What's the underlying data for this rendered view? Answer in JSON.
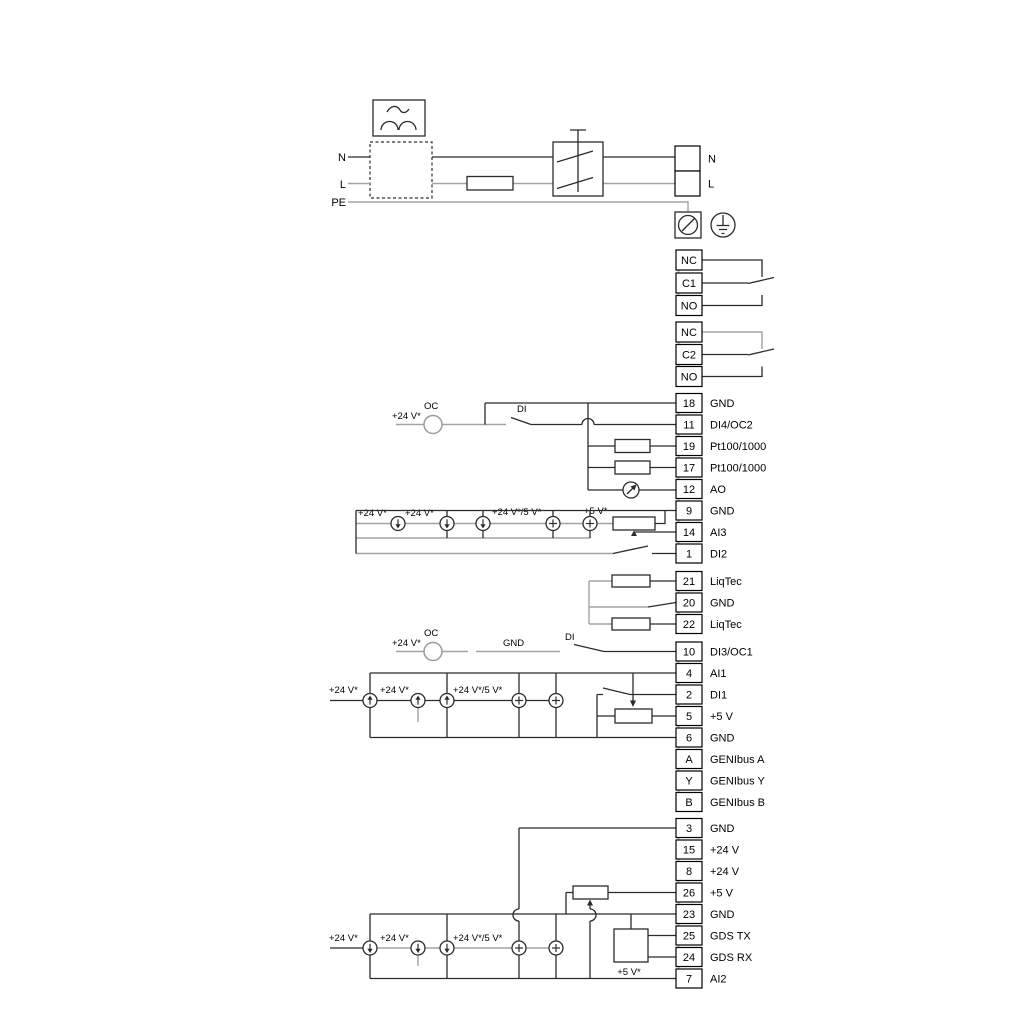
{
  "colors": {
    "wire_dark": "#2b2b2b",
    "wire_gray": "#a3a3a3",
    "background": "#ffffff"
  },
  "mains": {
    "n_in": "N",
    "l_in": "L",
    "pe": "PE"
  },
  "labels": {
    "g2_supply": "+24 V*",
    "g2_oc": "OC",
    "g2_di": "DI",
    "rowA_s1": "+24 V*",
    "rowA_s2": "+24 V*",
    "rowA_s3": "+24 V*/5 V*",
    "rowA_s4": "+5 V*",
    "g4_supply": "+24 V*",
    "g4_oc": "OC",
    "g4_gnd": "GND",
    "g4_di": "DI",
    "rowB_s1": "+24 V*",
    "rowB_s2": "+24 V*",
    "rowB_s3": "+24 V*/5 V*",
    "rowC_s1": "+24 V*",
    "rowC_s2": "+24 V*",
    "rowC_s3": "+24 V*/5 V*",
    "rowC_s4": "+5 V*"
  },
  "terminal_groups": [
    {
      "id": "mains-out",
      "x": 675,
      "w": 25,
      "h": 25,
      "label_x": 708,
      "ys": [
        158.5,
        183.5
      ],
      "cells": [
        {
          "num": "",
          "label": "N"
        },
        {
          "num": "",
          "label": "L"
        }
      ]
    },
    {
      "id": "relay1",
      "x": 676,
      "w": 26,
      "h": 20,
      "label_x": 710,
      "ys": [
        260,
        283,
        305.5
      ],
      "cells": [
        {
          "num": "NC",
          "label": ""
        },
        {
          "num": "C1",
          "label": ""
        },
        {
          "num": "NO",
          "label": ""
        }
      ]
    },
    {
      "id": "relay2",
      "x": 676,
      "w": 26,
      "h": 20,
      "label_x": 710,
      "ys": [
        332,
        354.5,
        376.5
      ],
      "cells": [
        {
          "num": "NC",
          "label": ""
        },
        {
          "num": "C2",
          "label": ""
        },
        {
          "num": "NO",
          "label": ""
        }
      ]
    },
    {
      "id": "io1",
      "x": 676,
      "w": 26,
      "h": 19,
      "label_x": 710,
      "ys": [
        403,
        424.5,
        446,
        467.5,
        489,
        510.5,
        532,
        553.5
      ],
      "cells": [
        {
          "num": "18",
          "label": "GND"
        },
        {
          "num": "11",
          "label": "DI4/OC2"
        },
        {
          "num": "19",
          "label": "Pt100/1000"
        },
        {
          "num": "17",
          "label": "Pt100/1000"
        },
        {
          "num": "12",
          "label": "AO"
        },
        {
          "num": "9",
          "label": "GND"
        },
        {
          "num": "14",
          "label": "AI3"
        },
        {
          "num": "1",
          "label": "DI2"
        }
      ]
    },
    {
      "id": "io2",
      "x": 676,
      "w": 26,
      "h": 19,
      "label_x": 710,
      "ys": [
        581,
        602.5,
        624
      ],
      "cells": [
        {
          "num": "21",
          "label": "LiqTec"
        },
        {
          "num": "20",
          "label": "GND"
        },
        {
          "num": "22",
          "label": "LiqTec"
        }
      ]
    },
    {
      "id": "io3",
      "x": 676,
      "w": 26,
      "h": 19,
      "label_x": 710,
      "ys": [
        651.5,
        673,
        694.5,
        716,
        737.5,
        759,
        780.5,
        802
      ],
      "cells": [
        {
          "num": "10",
          "label": "DI3/OC1"
        },
        {
          "num": "4",
          "label": "AI1"
        },
        {
          "num": "2",
          "label": "DI1"
        },
        {
          "num": "5",
          "label": "+5 V"
        },
        {
          "num": "6",
          "label": "GND"
        },
        {
          "num": "A",
          "label": "GENIbus A"
        },
        {
          "num": "Y",
          "label": "GENIbus Y"
        },
        {
          "num": "B",
          "label": "GENIbus B"
        }
      ]
    },
    {
      "id": "io4",
      "x": 676,
      "w": 26,
      "h": 19,
      "label_x": 710,
      "ys": [
        828,
        849.5,
        871,
        892.5,
        914,
        935.5,
        957,
        978.5
      ],
      "cells": [
        {
          "num": "3",
          "label": "GND"
        },
        {
          "num": "15",
          "label": "+24 V"
        },
        {
          "num": "8",
          "label": "+24 V"
        },
        {
          "num": "26",
          "label": "+5 V"
        },
        {
          "num": "23",
          "label": "GND"
        },
        {
          "num": "25",
          "label": "GDS TX"
        },
        {
          "num": "24",
          "label": "GDS RX"
        },
        {
          "num": "7",
          "label": "AI2"
        }
      ]
    }
  ]
}
